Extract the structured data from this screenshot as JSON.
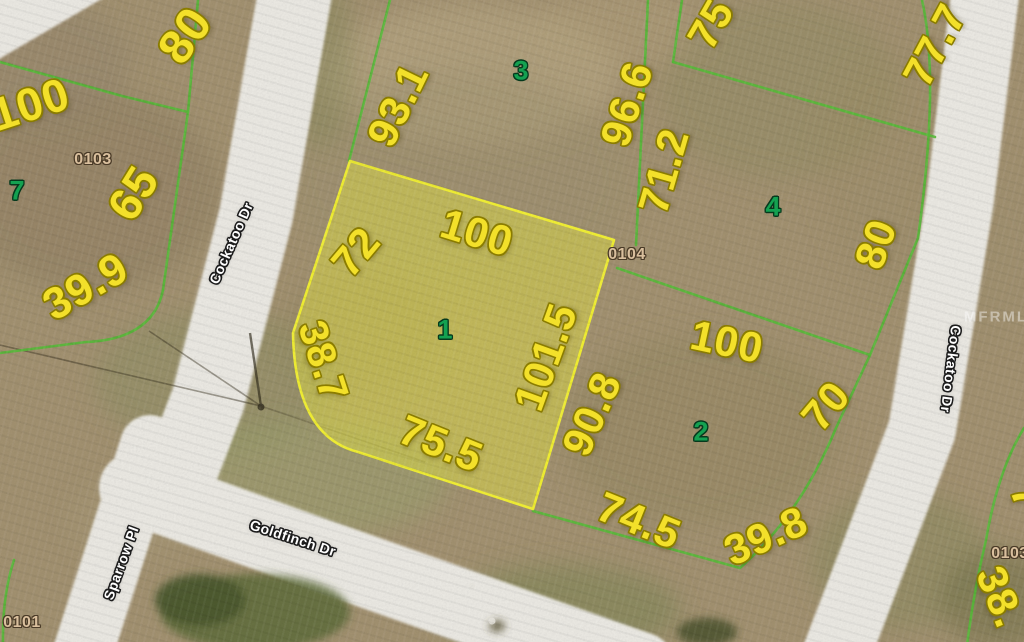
{
  "colors": {
    "ground": "#a29170",
    "road": "#ebe9e3",
    "boundary_line": "#58ba3a",
    "subject_parcel_fill": "#e2e045",
    "subject_parcel_outline": "#f1ef33",
    "dimension_text": "#f3e02a",
    "dimension_outline": "#8a7c00",
    "lot_number_text": "#14a151",
    "lot_number_outline": "#06391d",
    "plat_number_text": "#d9bf9d",
    "plat_number_outline": "#4a3b28",
    "street_text": "#ffffff",
    "street_outline": "#1c1c1c",
    "watermark_text": "#ffffff"
  },
  "subject_parcel": {
    "lot_number": "1"
  },
  "dimension_labels": [
    {
      "text": "80",
      "x": 186,
      "y": 36,
      "rot": -55,
      "size": 48
    },
    {
      "text": "100",
      "x": 30,
      "y": 104,
      "rot": -18,
      "size": 46
    },
    {
      "text": "65",
      "x": 133,
      "y": 193,
      "rot": -58,
      "size": 46
    },
    {
      "text": "39.9",
      "x": 86,
      "y": 287,
      "rot": -30,
      "size": 44
    },
    {
      "text": "93.1",
      "x": 398,
      "y": 105,
      "rot": -64,
      "size": 42
    },
    {
      "text": "96.6",
      "x": 627,
      "y": 104,
      "rot": -72,
      "size": 42
    },
    {
      "text": "71.2",
      "x": 664,
      "y": 171,
      "rot": -74,
      "size": 42
    },
    {
      "text": "75",
      "x": 711,
      "y": 24,
      "rot": -60,
      "size": 42
    },
    {
      "text": "77.7",
      "x": 935,
      "y": 45,
      "rot": -62,
      "size": 42
    },
    {
      "text": "80",
      "x": 876,
      "y": 244,
      "rot": -70,
      "size": 42
    },
    {
      "text": "100",
      "x": 727,
      "y": 342,
      "rot": 12,
      "size": 42
    },
    {
      "text": "70",
      "x": 826,
      "y": 406,
      "rot": -50,
      "size": 42
    },
    {
      "text": "39.8",
      "x": 766,
      "y": 536,
      "rot": -24,
      "size": 42
    },
    {
      "text": "74.5",
      "x": 639,
      "y": 521,
      "rot": 22,
      "size": 42
    },
    {
      "text": "90.8",
      "x": 592,
      "y": 414,
      "rot": -66,
      "size": 42
    },
    {
      "text": "101.5",
      "x": 546,
      "y": 357,
      "rot": -70,
      "size": 42
    },
    {
      "text": "100",
      "x": 477,
      "y": 233,
      "rot": 17,
      "size": 42
    },
    {
      "text": "72",
      "x": 356,
      "y": 252,
      "rot": -50,
      "size": 42
    },
    {
      "text": "38.7",
      "x": 323,
      "y": 361,
      "rot": 72,
      "size": 40
    },
    {
      "text": "75.5",
      "x": 441,
      "y": 444,
      "rot": 22,
      "size": 42
    },
    {
      "text": "38.",
      "x": 1000,
      "y": 597,
      "rot": 68,
      "size": 42
    },
    {
      "text": "7",
      "x": 1027,
      "y": 496,
      "rot": 68,
      "size": 42
    }
  ],
  "lot_numbers": [
    {
      "text": "7",
      "x": 17,
      "y": 191,
      "rot": 0
    },
    {
      "text": "3",
      "x": 521,
      "y": 71,
      "rot": 0
    },
    {
      "text": "4",
      "x": 773,
      "y": 207,
      "rot": 0
    },
    {
      "text": "1",
      "x": 445,
      "y": 330,
      "rot": 0
    },
    {
      "text": "2",
      "x": 701,
      "y": 432,
      "rot": 0
    }
  ],
  "plat_numbers": [
    {
      "text": "0103",
      "x": 93,
      "y": 160,
      "rot": 0
    },
    {
      "text": "0104",
      "x": 627,
      "y": 255,
      "rot": 0
    },
    {
      "text": "0103",
      "x": 1010,
      "y": 554,
      "rot": 0
    },
    {
      "text": "0101",
      "x": 22,
      "y": 623,
      "rot": 0
    }
  ],
  "street_labels": [
    {
      "text": "Cockatoo Dr",
      "x": 231,
      "y": 243,
      "rot": -66
    },
    {
      "text": "Cockatoo Dr",
      "x": 951,
      "y": 369,
      "rot": 97
    },
    {
      "text": "Sparrow Pl",
      "x": 121,
      "y": 563,
      "rot": -70
    },
    {
      "text": "Goldfinch Dr",
      "x": 293,
      "y": 538,
      "rot": 18
    }
  ],
  "watermark": {
    "text": "MFRMLS",
    "x": 1002,
    "y": 317,
    "rot": 0
  }
}
